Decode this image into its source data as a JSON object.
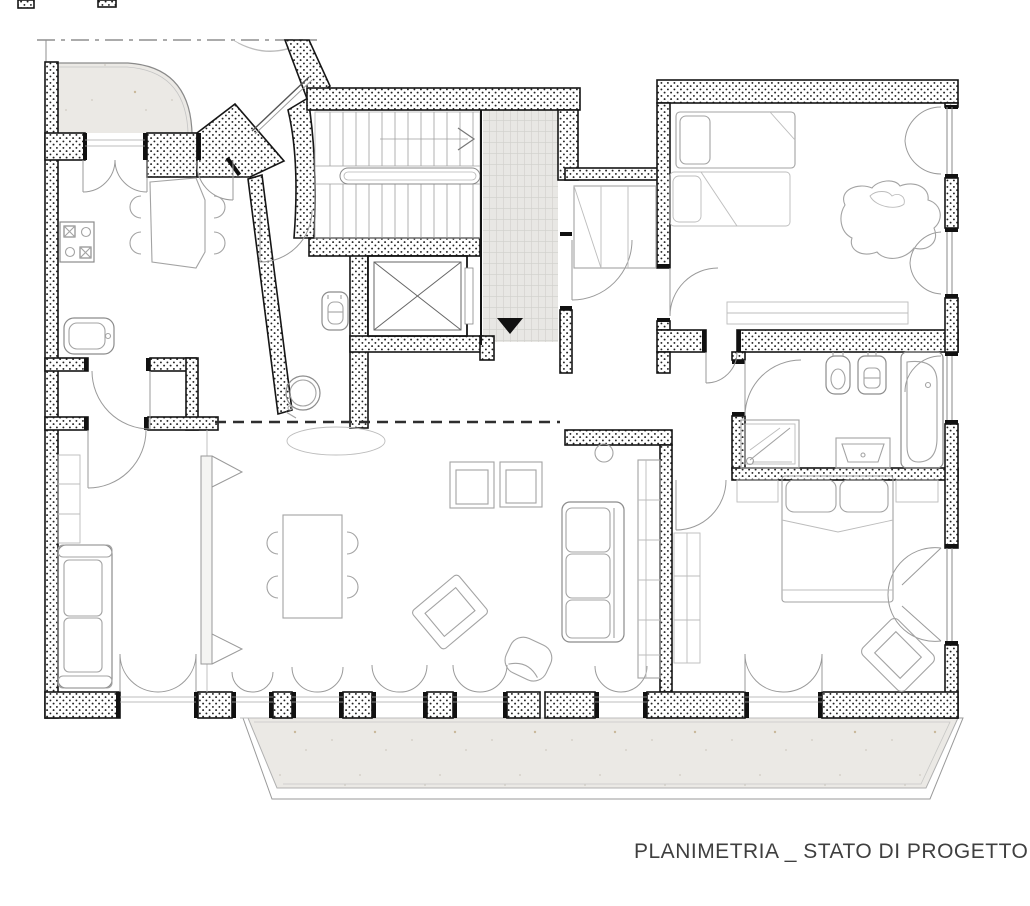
{
  "caption": {
    "text": "PLANIMETRIA _ STATO DI PROGETTO"
  },
  "drawing": {
    "type": "architectural-floor-plan",
    "marker_glyphs": {
      "entrance_direction": "▼",
      "stair_direction": ">"
    }
  },
  "palette": {
    "background": "#ffffff",
    "wall_line": "#161616",
    "wall_dot": "#222222",
    "furniture_line": "#a3a3a3",
    "stone_fill": "#ebe9e5",
    "tile_fill": "#e8e7e4",
    "caption_color": "#3f3f3f",
    "reference_line": "#8f8f8f"
  }
}
